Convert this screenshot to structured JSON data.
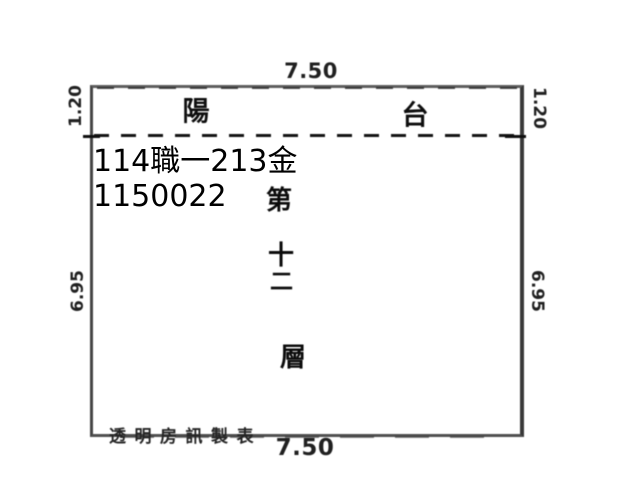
{
  "plan": {
    "balcony_label_left": "陽",
    "balcony_label_right": "台",
    "floor_label_chars": [
      "第",
      "十",
      "二",
      "層"
    ],
    "dimensions": {
      "top": "7.50",
      "bottom": "7.50",
      "left_upper": "1.20",
      "right_upper": "1.20",
      "left_lower": "6.95",
      "right_lower": "6.95"
    },
    "watermark": {
      "line1": "114職一213金",
      "line2": "1150022"
    },
    "credit": "透明房訊製表"
  },
  "colors": {
    "background": "#ffffff",
    "line": "#4a4a4a",
    "dash_line": "#161616",
    "text": "#161616",
    "watermark_text": "#000000"
  }
}
